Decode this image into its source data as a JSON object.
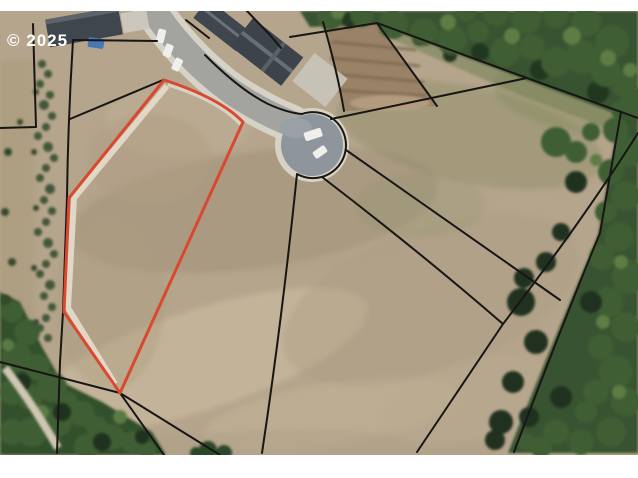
{
  "watermark": {
    "text": "© 2025"
  },
  "colors": {
    "page_background": "#ffffff",
    "highlight_lot_outline": "#d9482f",
    "parcel_line": "#181614",
    "field_tan": "#b5a58c",
    "road_asphalt": "#a3a39f",
    "sidewalk_concrete": "#d6d2c6",
    "culdesac_pavement": "#8f959d",
    "tree_green": "#375331",
    "roof_gray": "#40464d",
    "watermark_text": "#ffffff",
    "vehicle_blue": "#4678b4",
    "vehicle_white": "#f0efec"
  },
  "features": {
    "photo": "aerial photo of subdivision lots",
    "road": "residential street",
    "cul_de_sac": "cul-de-sac turnaround",
    "highlighted_lot": "lot for sale outlined in red",
    "parcel_lines": "lot boundary lines",
    "trees_right": "tree cover right side",
    "trees_bottom_left": "tree cover bottom left",
    "shrub_row": "row of planted shrubs",
    "houses": "house roofs along street",
    "vehicles": "parked vehicles",
    "construction_lot": "graded dirt lot"
  }
}
